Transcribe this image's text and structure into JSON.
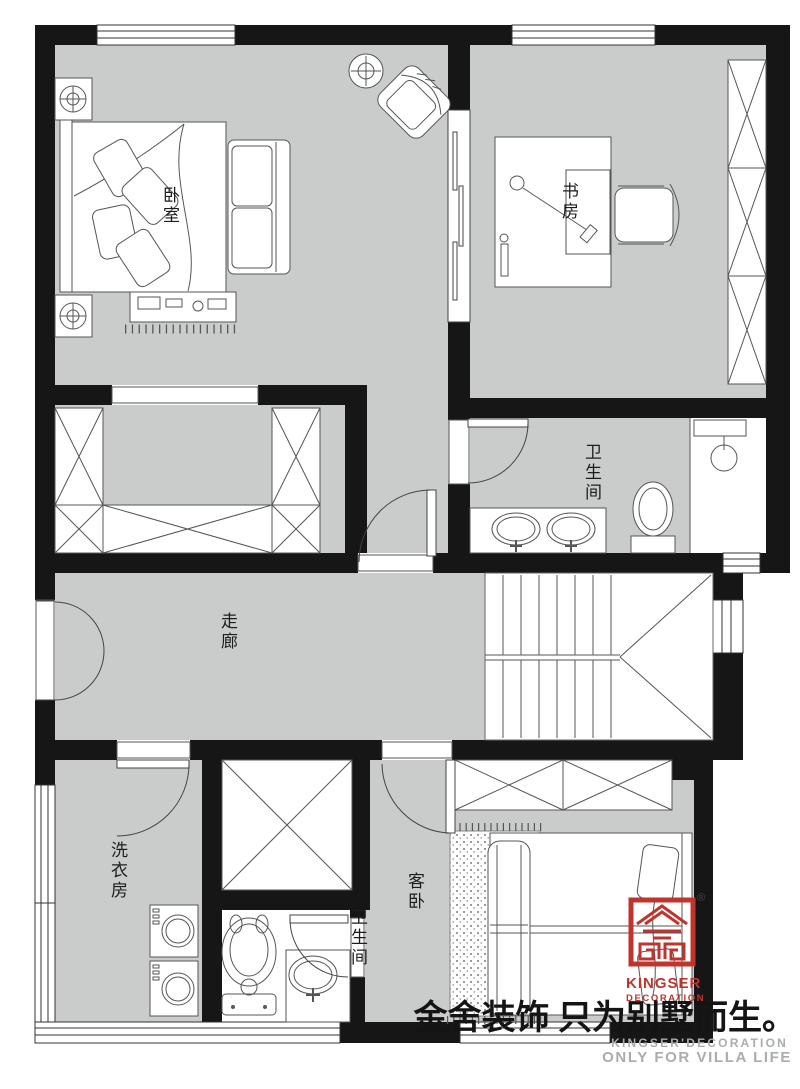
{
  "floorplan": {
    "rooms": {
      "master_bedroom": "卧室",
      "study": "书房",
      "bathroom_main": "卫生间",
      "corridor": "走廊",
      "laundry": "洗衣房",
      "bathroom_small": "卫生间",
      "guest_bedroom": "客卧"
    },
    "branding": {
      "logo_word": "KINGSER",
      "logo_sub": "DECORATION",
      "registered": "®",
      "slogan_cn": "金舍装饰 只为别墅而生。",
      "brand_en": "KINGSER'DECORATION",
      "tagline_en": "ONLY FOR VILLA LIFE"
    },
    "colors": {
      "wall": "#161616",
      "floor": "#c9cccb",
      "logo_red": "#c0342e",
      "muted_text": "#a9adac"
    }
  }
}
